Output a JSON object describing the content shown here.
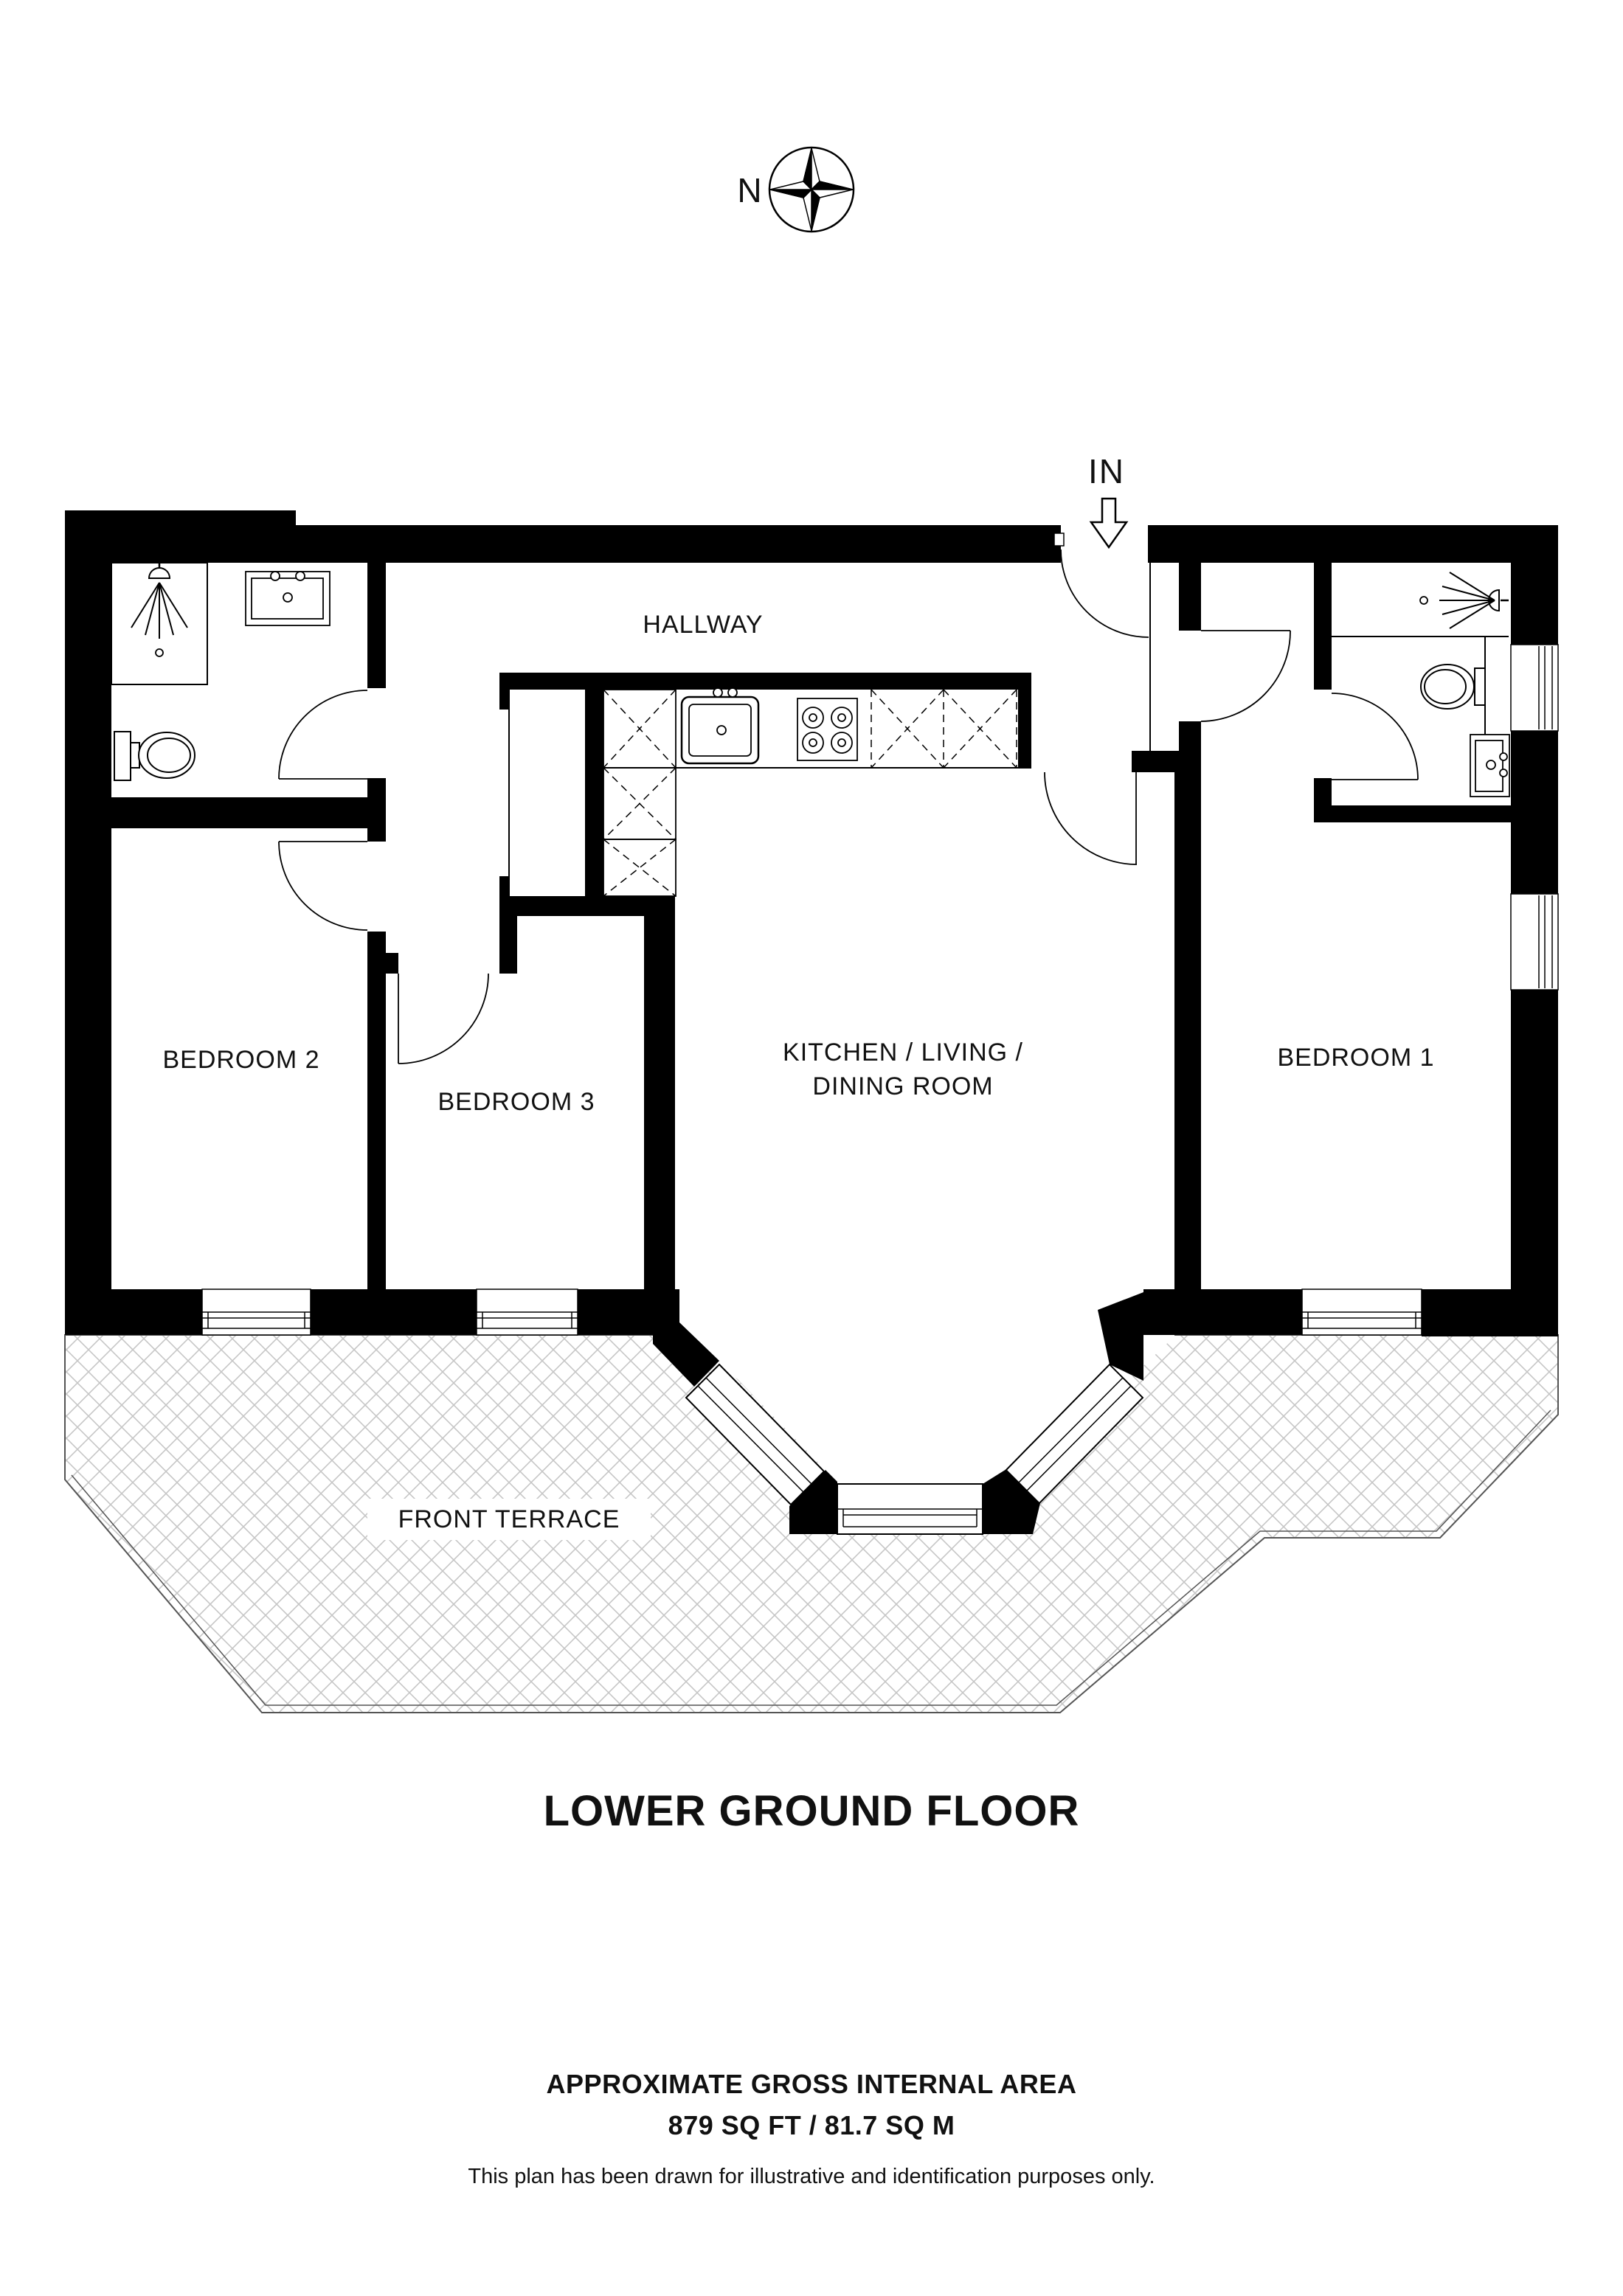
{
  "plan": {
    "compass_label": "N",
    "entrance_label": "IN",
    "rooms": {
      "hallway": "HALLWAY",
      "bedroom2": "BEDROOM 2",
      "bedroom3": "BEDROOM 3",
      "kitchen_line1": "KITCHEN / LIVING /",
      "kitchen_line2": "DINING ROOM",
      "bedroom1": "BEDROOM 1",
      "terrace": "FRONT TERRACE"
    }
  },
  "footer": {
    "title": "LOWER GROUND FLOOR",
    "area_heading": "APPROXIMATE GROSS INTERNAL AREA",
    "area_value": "879 SQ FT / 81.7 SQ M",
    "disclaimer": "This plan has been drawn for illustrative and identification purposes only."
  },
  "colors": {
    "wall": "#000000",
    "hatch": "#c6c6c6",
    "line": "#000000"
  }
}
